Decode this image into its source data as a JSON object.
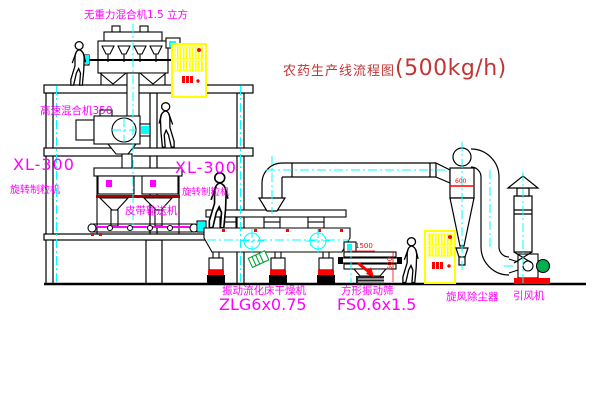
{
  "title": {
    "text": "农药生产线流程图",
    "capacity": "(500kg/h)"
  },
  "labels": {
    "gravity_mixer": "无重力混合机1.5 立方",
    "high_speed_mixer": "高速混合机350",
    "granulator_left_model": "XL-300",
    "granulator_left_name": "旋转制粒机",
    "granulator_center_model": "XL-300",
    "granulator_center_name": "旋转制粒机",
    "belt_conveyor": "皮带输送机",
    "dryer_name": "振动流化床干燥机",
    "dryer_model": "ZLG6x0.75",
    "screen_name": "方形振动筛",
    "screen_model": "FS0.6x1.5",
    "cyclone": "旋风除尘器",
    "induced_draft_fan": "引风机"
  },
  "dimensions": {
    "screen_length": "1500",
    "screen_height": "500",
    "cyclone_marking": "600"
  },
  "colors": {
    "label_magenta": "#ff00ff",
    "title_red": "#c23535",
    "line_black": "#000000",
    "centerline_cyan": "#00ffff",
    "cabinet_yellow": "#ffff00",
    "detail_red": "#ff0000",
    "dark_red": "#aa0000",
    "motor_green": "#00b050"
  }
}
